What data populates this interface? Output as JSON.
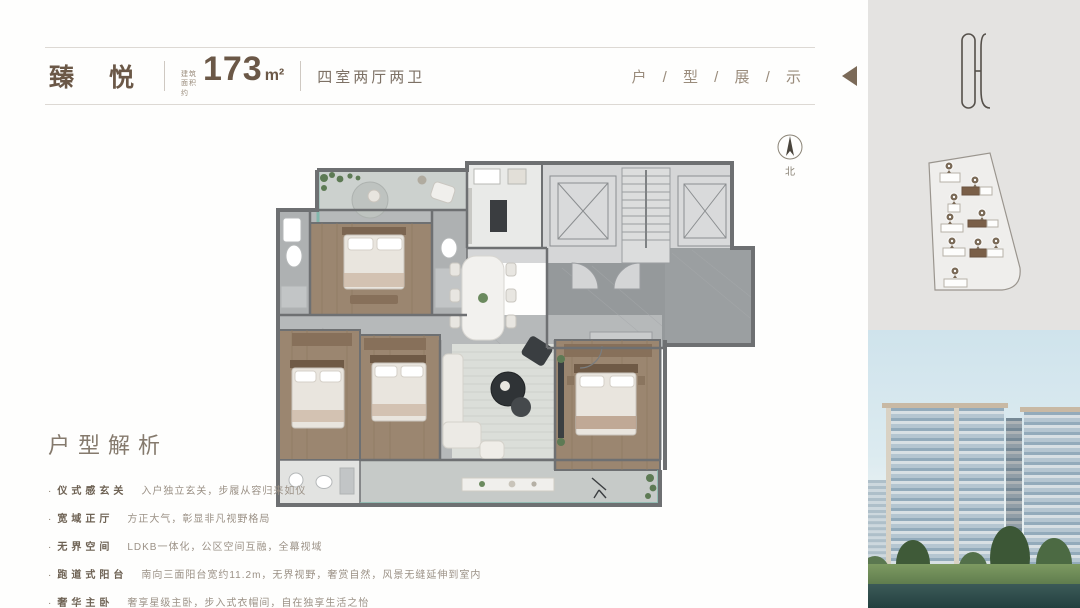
{
  "header": {
    "brand": "臻 悦",
    "area_label": "建筑面积约",
    "area_value": "173",
    "area_unit": "m²",
    "layout": "四室两厅两卫",
    "section_title": "户 / 型 / 展 / 示"
  },
  "compass": {
    "north_label": "北"
  },
  "analysis": {
    "title": "户型解析",
    "bullet": "·",
    "items": [
      {
        "label": "仪式感玄关",
        "desc": "入户独立玄关，步履从容归来如仪"
      },
      {
        "label": "宽域正厅",
        "desc": "方正大气，彰显非凡视野格局"
      },
      {
        "label": "无界空间",
        "desc": "LDKB一体化，公区空间互融，全幕视域"
      },
      {
        "label": "跑道式阳台",
        "desc": "南向三面阳台宽约11.2m，无界视野，奢赏自然，风景无缝延伸到室内"
      },
      {
        "label": "奢华主卧",
        "desc": "奢享星级主卧，步入式衣帽间，自在独享生活之怡"
      }
    ]
  },
  "colors": {
    "brand_brown": "#6b5847",
    "accent_brown": "#7b6a58",
    "panel_gray": "#e4e3e1",
    "balcony_teal": "#82b7ac",
    "wall_gray": "#6e7072",
    "wood_floor": "#9b8670",
    "site_highlight": "#7a5f48"
  }
}
